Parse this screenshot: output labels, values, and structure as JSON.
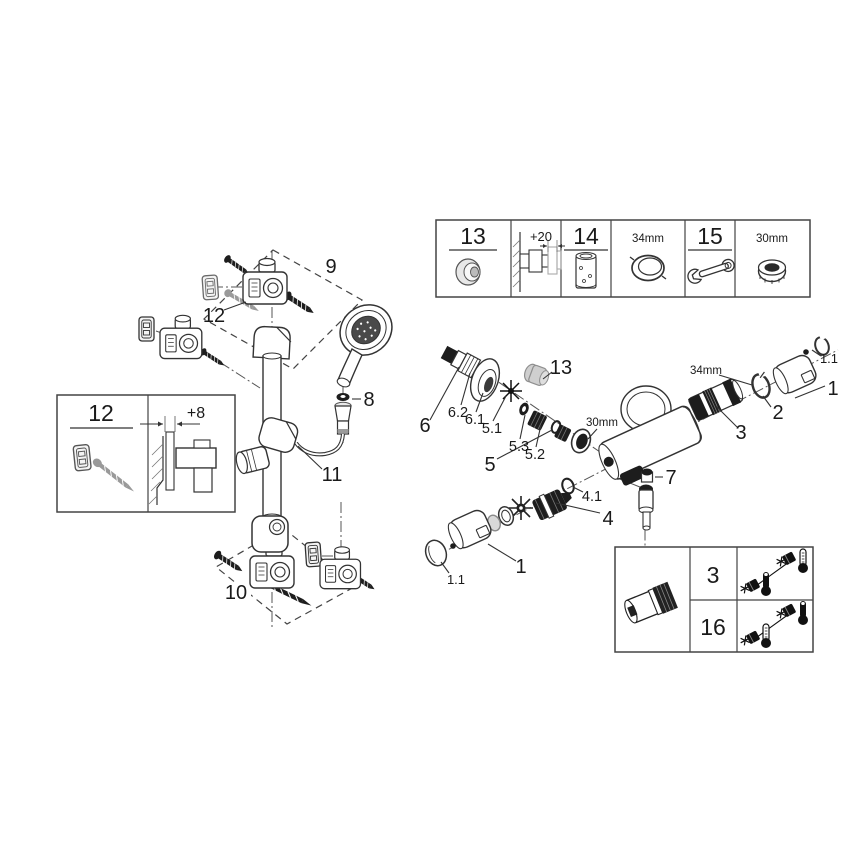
{
  "doc": {
    "top_box": {
      "item13": "13",
      "dim": "+20",
      "item14": "14",
      "size34": "34mm",
      "item15": "15",
      "size30": "30mm"
    },
    "wall_box": {
      "item": "12",
      "dim": "+8"
    },
    "rail": {
      "group9": "9",
      "fix12": "12",
      "washer8": "8",
      "holder11": "11",
      "group10": "10"
    },
    "mixer": {
      "g6": "6",
      "g62": "6.2",
      "g61": "6.1",
      "g51": "5.1",
      "g53": "5.3",
      "g52": "5.2",
      "g5": "5",
      "cap13": "13",
      "size30": "30mm",
      "size34": "34mm",
      "g2": "2",
      "g3": "3",
      "g1top": "1",
      "g11top": "1.1",
      "g7": "7",
      "g41": "4.1",
      "g4": "4",
      "g1bot": "1",
      "g11bot": "1.1"
    },
    "temp_box": {
      "row3": "3",
      "row16": "16"
    },
    "colors": {
      "line": "#2a2a2a",
      "dark_part": "#1d1d1d",
      "grey_part": "#cfcfcf"
    }
  }
}
